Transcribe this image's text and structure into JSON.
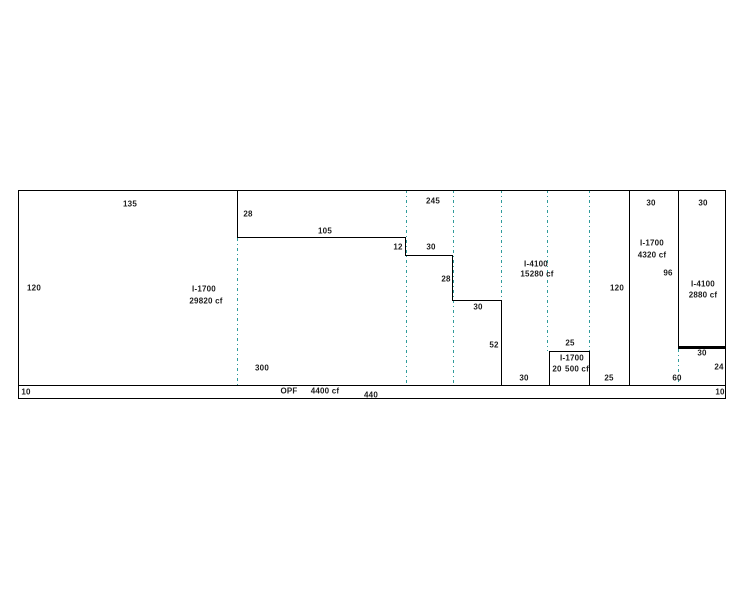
{
  "drawing": {
    "divider_color": "#2E9B9B",
    "line_color": "#000000",
    "labels": {
      "top_135": "135",
      "left_120": "120",
      "r1_name": "I-1700",
      "r1_vol": "29820 cf",
      "r1_bottom_300": "300",
      "step1_28": "28",
      "step1_105": "105",
      "step2_12": "12",
      "step2_30": "30",
      "top_245": "245",
      "step3_28": "28",
      "step3_30": "30",
      "step4_52": "52",
      "r2_name": "I-4100",
      "r2_vol": "15280 cf",
      "bottom_30": "30",
      "box_top_25": "25",
      "box_name": "I-1700",
      "box_20": "20",
      "box_vol": "500 cf",
      "bottom_25": "25",
      "right_120": "120",
      "r3_top_30": "30",
      "r3_name": "I-1700",
      "r3_vol": "4320 cf",
      "r3_96": "96",
      "r4_top_30": "30",
      "r4_name": "I-4100",
      "r4_vol": "2880 cf",
      "r4_lower_30": "30",
      "r4_lower_24": "24",
      "bottom_60": "60",
      "strip_left_10": "10",
      "strip_opf": "OPF",
      "strip_vol": "4400 cf",
      "strip_440": "440",
      "strip_right_10": "10"
    }
  }
}
